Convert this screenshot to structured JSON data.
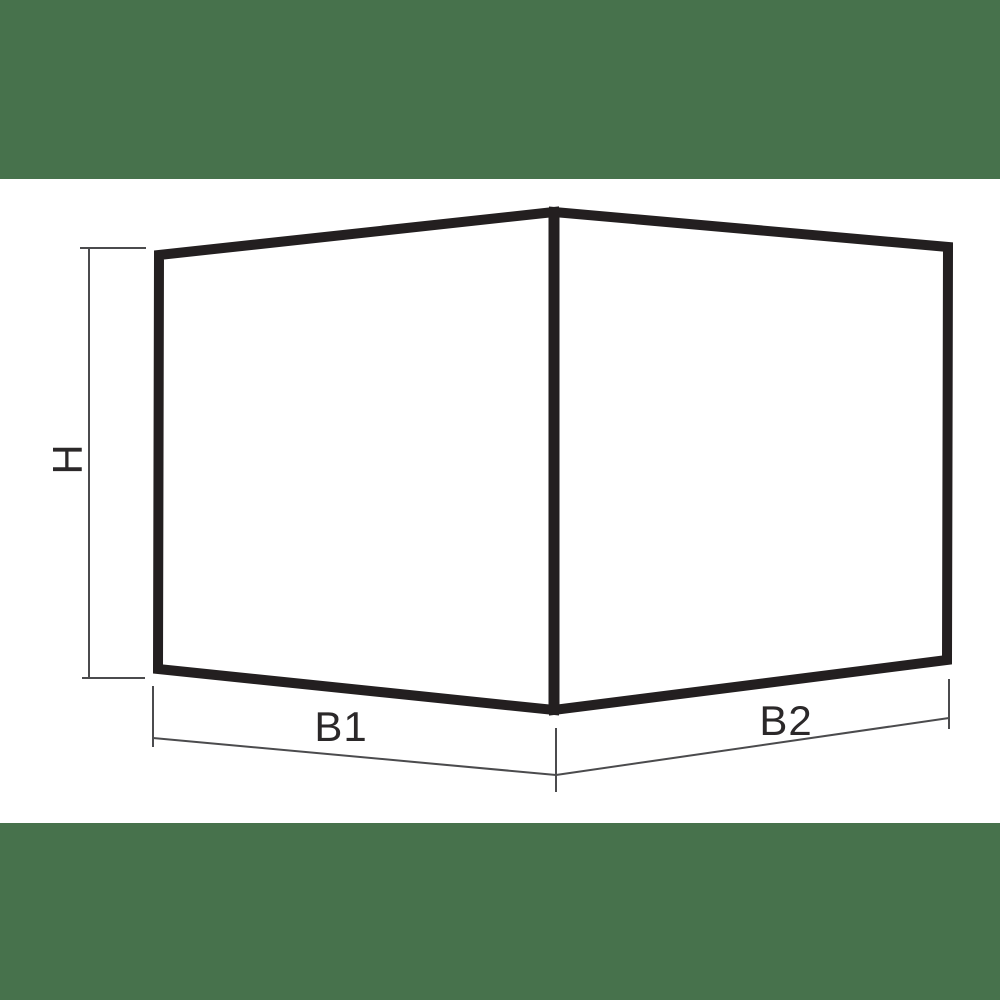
{
  "colors": {
    "banner_green": "#47724c",
    "outline_black": "#231f20",
    "panel_fill": "#ffffff",
    "dimension_gray": "#4b4b4d",
    "label_black": "#2b2829"
  },
  "diagram": {
    "type": "technical-drawing",
    "labels": {
      "height": "H",
      "base_left": "B1",
      "base_right": "B2"
    }
  }
}
